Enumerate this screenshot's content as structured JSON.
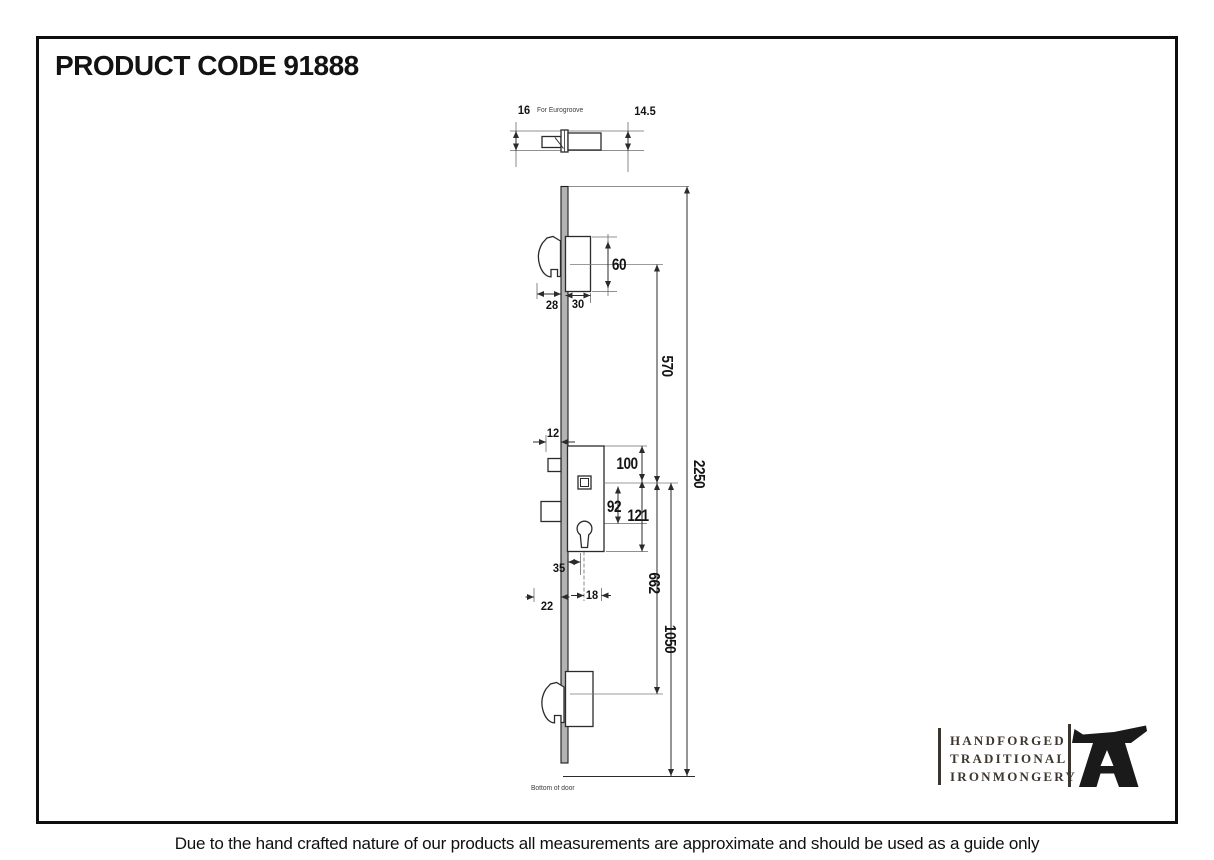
{
  "title": "PRODUCT CODE 91888",
  "disclaimer": "Due to the hand crafted nature of our products all measurements are approximate and should be used as a guide only",
  "drawing": {
    "top_detail": {
      "width_left": "16",
      "width_right": "14.5",
      "note": "For Eurogroove"
    },
    "top_hook": {
      "hook_depth": "28",
      "body_width": "30",
      "body_height": "60"
    },
    "gearbox": {
      "faceplate_offset": "12",
      "case_top_to_spindle": "100",
      "spindle_to_cylinder": "92",
      "spindle_to_case_bottom": "121",
      "cylinder_offset": "35",
      "cylinder_width": "18",
      "backset": "22"
    },
    "spans": {
      "hook_to_center": "570",
      "overall_height": "2250",
      "center_to_bottom_hook": "662",
      "center_to_door_bottom": "1050"
    },
    "bottom_note": "Bottom of door"
  },
  "logo": {
    "line1": "HANDFORGED",
    "line2": "TRADITIONAL",
    "line3": "IRONMONGERY"
  },
  "colors": {
    "line": "#2b2b2b",
    "faceplate_fill": "#b3b3b3",
    "logo_text": "#3d372f",
    "anvil": "#1a1a1a"
  }
}
